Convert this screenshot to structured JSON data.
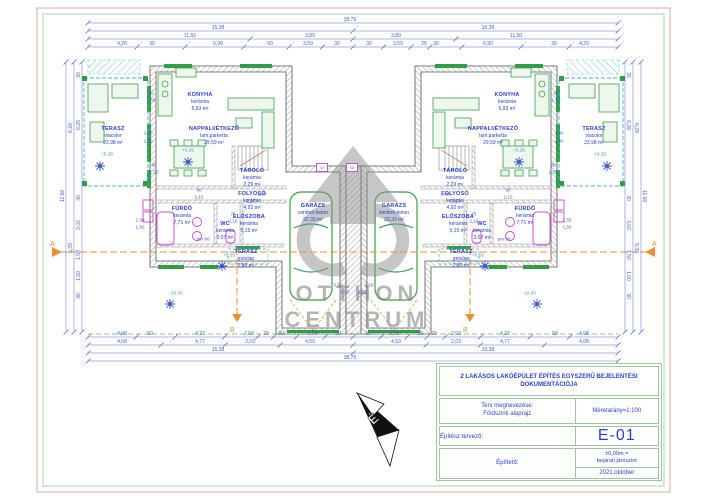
{
  "doc": {
    "title": "2 LAKÁSOS LAKÓÉPÜLET ÉPÍTÉS EGYSZERŰ BEJELENTÉSI DOKUMENTÁCIÓJA",
    "plan_label": "Terv megnevezése:",
    "plan_name": "Földszinti alaprajz",
    "scale": "Méretarány=1:100",
    "architect_label": "Építész tervező:",
    "sheet": "E-01",
    "client_label": "Építtető:",
    "level_note1": "±0,00m =",
    "level_note2": "bejárati járószint",
    "date": "2021.október"
  },
  "watermark": {
    "line1": "OTTHON",
    "line2": "CENTRUM"
  },
  "units": [
    {
      "id": "lakas-1",
      "rooms": [
        {
          "key": "terasz_nagy",
          "name": "TERASZ",
          "material": "viacolor",
          "area": "23,98 m²"
        },
        {
          "key": "konyha",
          "name": "KONYHA",
          "material": "kerámia",
          "area": "5,93 m²"
        },
        {
          "key": "nappali",
          "name": "NAPPALI/ÉTKEZŐ",
          "material": "lam.parketta",
          "area": "29,59 m²"
        },
        {
          "key": "tarolo",
          "name": "TÁROLÓ",
          "material": "kerámia",
          "area": "2,29 m²"
        },
        {
          "key": "folyoso",
          "name": "FOLYOSÓ",
          "material": "kerámia",
          "area": "4,92 m²"
        },
        {
          "key": "furdo",
          "name": "FÜRDŐ",
          "material": "kerámia",
          "area": "7,71 m²"
        },
        {
          "key": "wc",
          "name": "WC",
          "material": "kerámia",
          "area": "2,07 m²"
        },
        {
          "key": "eloszoba",
          "name": "ELŐSZOBA",
          "material": "kerámia",
          "area": "5,15 m²"
        },
        {
          "key": "terasz_kis",
          "name": "TERASZ",
          "material": "gréslap",
          "area": "2,80 m²"
        },
        {
          "key": "garazs",
          "name": "GARÁZS",
          "material": "simított beton",
          "area": "22,33 m²"
        }
      ]
    },
    {
      "id": "lakas-2",
      "rooms": [
        {
          "key": "terasz_nagy",
          "name": "TERASZ",
          "material": "viacolor",
          "area": "23,98 m²"
        },
        {
          "key": "konyha",
          "name": "KONYHA",
          "material": "kerámia",
          "area": "5,93 m²"
        },
        {
          "key": "nappali",
          "name": "NAPPALI/ÉTKEZŐ",
          "material": "lam.parketta",
          "area": "29,59 m²"
        },
        {
          "key": "tarolo",
          "name": "TÁROLÓ",
          "material": "kerámia",
          "area": "2,29 m²"
        },
        {
          "key": "folyoso",
          "name": "FOLYOSÓ",
          "material": "kerámia",
          "area": "4,92 m²"
        },
        {
          "key": "furdo",
          "name": "FÜRDŐ",
          "material": "kerámia",
          "area": "7,71 m²"
        },
        {
          "key": "wc",
          "name": "WC",
          "material": "kerámia",
          "area": "2,07 m²"
        },
        {
          "key": "eloszoba",
          "name": "ELŐSZOBA",
          "material": "kerámia",
          "area": "5,15 m²"
        },
        {
          "key": "terasz_kis",
          "name": "TERASZ",
          "material": "gréslap",
          "area": "2,80 m²"
        },
        {
          "key": "garazs",
          "name": "GARÁZS",
          "material": "simított beton",
          "area": "22,33 m²"
        }
      ]
    }
  ],
  "levels": [
    "+0,35",
    "+0,35",
    "+0,05",
    "±0,00"
  ],
  "section_markers": {
    "a": "A",
    "b": "B"
  },
  "vent_label": "U",
  "dimensions": {
    "top": [
      [
        "38,76"
      ],
      [
        "15,38",
        "15,38"
      ],
      [
        "11,50",
        "3,89",
        "3,89",
        "11,50"
      ],
      [
        "4,20",
        "30",
        "6,90",
        "50",
        "3,59",
        "30",
        "30",
        "3,59",
        "20",
        "30",
        "6,90",
        "30",
        "4,20"
      ]
    ],
    "bottom": [
      [
        "4,08",
        "50",
        "4,27",
        "2,03",
        "20",
        "30",
        "3,79",
        "30",
        "30",
        "3,79",
        "30",
        "20",
        "2,03",
        "4,27",
        "50",
        "4,08"
      ],
      [
        "4,08",
        "4,77",
        "2,03",
        "4,59",
        "4,59",
        "2,03",
        "4,77",
        "4,08"
      ],
      [
        "15,38",
        "15,38"
      ],
      [
        "38,76"
      ]
    ],
    "left": [
      "30",
      "6,28",
      "30",
      "3,02",
      "1,50",
      "1,00",
      "30",
      "6,28",
      "5,39",
      "11,68"
    ],
    "right": [
      "30",
      "6,28",
      "30",
      "3,02",
      "1,50",
      "1,00",
      "30",
      "6,28",
      "5,39",
      "11,68"
    ],
    "small": [
      "90",
      "1,50",
      "2,40",
      "2,40",
      "90",
      "1,50",
      "1,50",
      "1,50",
      "1,80",
      "2,10",
      "90",
      "2,10",
      "75",
      "2,10",
      "pm 90",
      "3,50",
      "2,55"
    ]
  }
}
